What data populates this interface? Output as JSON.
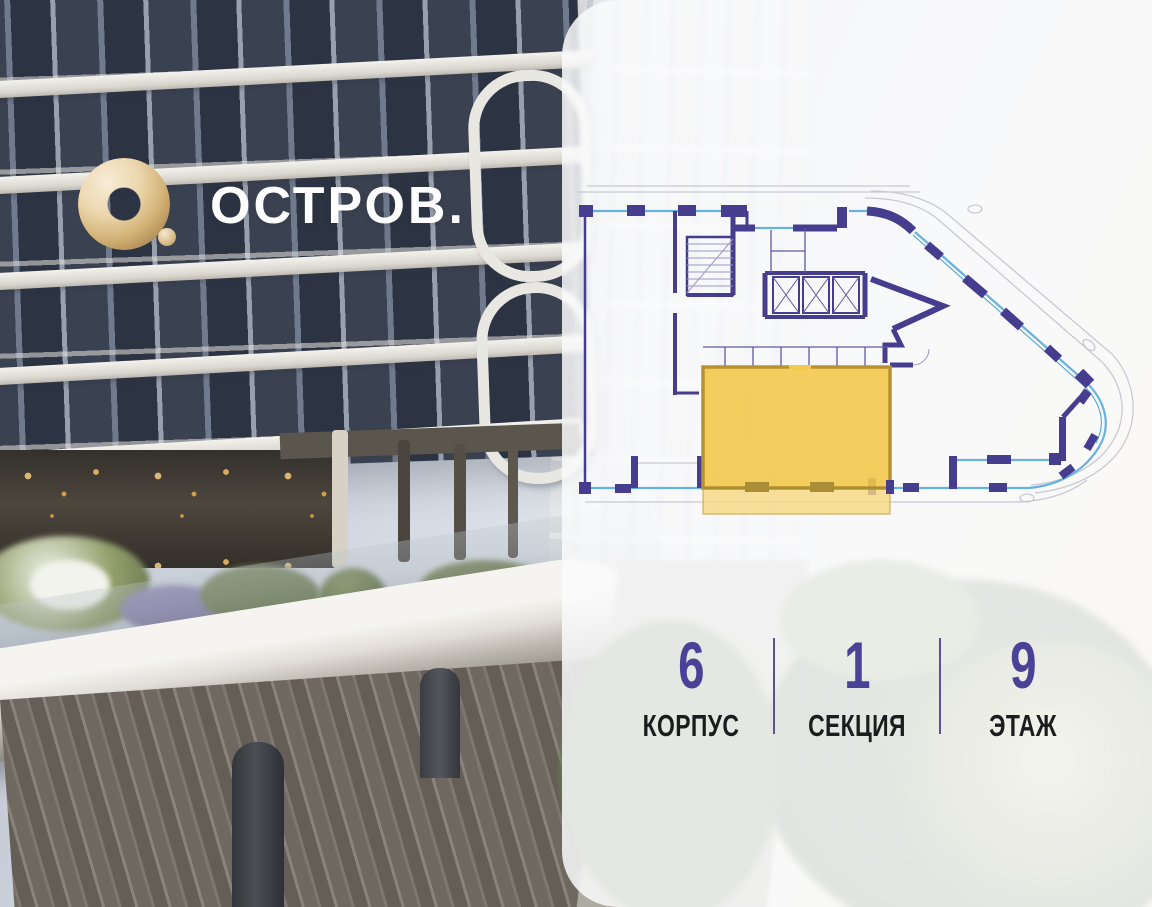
{
  "brand": {
    "name": "ОСТРОВ.",
    "logo_icon": "gold-torus-icon",
    "text_color": "#fdfdfd",
    "gold_color": "#d3b276"
  },
  "panel": {
    "background": "rgba(250,250,252,0.85)",
    "floor_plan": {
      "wall_color": "#463d8f",
      "window_color": "#68b2e0",
      "outline_color": "#c9c9d4",
      "highlight_color": "#f3c84e",
      "highlight_balcony_color": "#f6d87f",
      "selected_unit": "highlighted-apartment"
    },
    "stats": {
      "value_color": "#4a4297",
      "label_color": "#1c1c1e",
      "divider_color": "#5a529c",
      "items": [
        {
          "value": "6",
          "label": "КОРПУС"
        },
        {
          "value": "1",
          "label": "СЕКЦИЯ"
        },
        {
          "value": "9",
          "label": "ЭТАЖ"
        }
      ]
    }
  }
}
